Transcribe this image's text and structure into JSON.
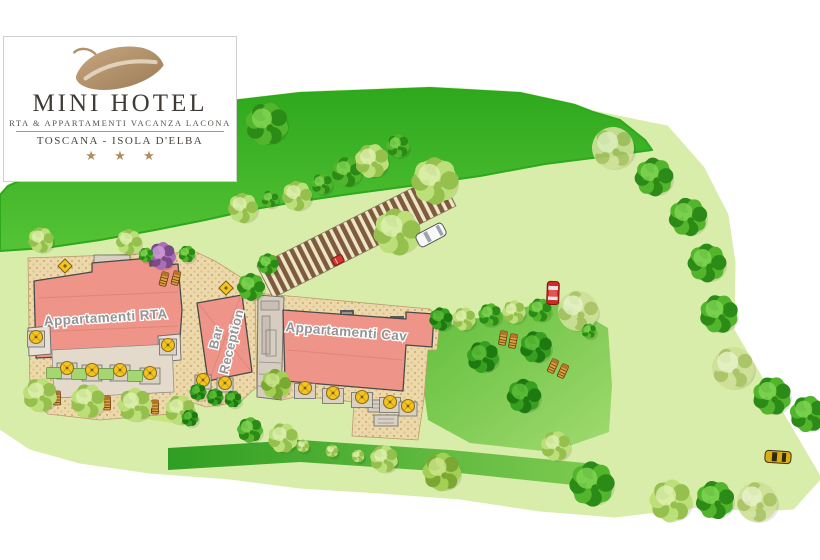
{
  "logo": {
    "hotel_name": "MINI HOTEL",
    "subtitle": "RTA & APPARTAMENTI VACANZA LACONA",
    "location": "TOSCANA - ISOLA D'ELBA",
    "stars": "★ ★ ★",
    "leaf_color": "#b3916f"
  },
  "map": {
    "labels": {
      "building_rta": "Appartamenti RTA",
      "building_bar_line1": "Bar",
      "building_bar_line2": "Reception",
      "building_cav": "Appartamenti Cav"
    },
    "palette": {
      "grounds": "#d8edaa",
      "upper_lawn_top": "#2ea81d",
      "upper_lawn_bottom": "#55c336",
      "sun_lawn_a": "#5fbe3a",
      "sun_lawn_b": "#a2da70",
      "hedge_a": "#2f9e22",
      "hedge_b": "#7cc94f",
      "shrub_band": "#c8e57f",
      "courtyard": "#ecd9ab",
      "courtyard_dots": "#d3ae74",
      "parking_stripe": "#7d5c3d",
      "parking_bg": "#f0e5c9",
      "building": "#ee9489",
      "building_outline": "#4a4a4a",
      "terrace": "#dad1c5",
      "planter": "#a6d672",
      "parasol": "#f3c41f",
      "lounger": "#e2a03a",
      "tree_green": [
        "#52b52c",
        "#2c8a16",
        "#86d957"
      ],
      "tree_dark": [
        "#38a021",
        "#1e7a10",
        "#63c23c"
      ],
      "tree_lime": [
        "#a4cf55",
        "#7aa832",
        "#d0e893"
      ],
      "tree_pale": [
        "#bcdf7a",
        "#95c04e",
        "#e2f2b4"
      ],
      "tree_sparse": [
        "#cfe098",
        "#a8c263",
        "#eef6d2"
      ],
      "tree_purple": [
        "#a96fb4",
        "#7c4a8a",
        "#d2a3da"
      ]
    },
    "trees": [
      [
        41,
        240,
        12,
        "pale"
      ],
      [
        129,
        242,
        12,
        "pale"
      ],
      [
        267,
        124,
        20,
        "green"
      ],
      [
        243,
        208,
        14,
        "pale"
      ],
      [
        270,
        199,
        8,
        "green"
      ],
      [
        297,
        196,
        14,
        "pale"
      ],
      [
        322,
        184,
        10,
        "green"
      ],
      [
        347,
        172,
        14,
        "green"
      ],
      [
        372,
        161,
        16,
        "pale"
      ],
      [
        398,
        146,
        11,
        "green"
      ],
      [
        162,
        256,
        13,
        "purple"
      ],
      [
        187,
        254,
        8,
        "green"
      ],
      [
        146,
        255,
        7,
        "green"
      ],
      [
        435,
        181,
        22,
        "pale"
      ],
      [
        397,
        232,
        22,
        "pale"
      ],
      [
        268,
        264,
        10,
        "green"
      ],
      [
        251,
        287,
        13,
        "green"
      ],
      [
        613,
        148,
        21,
        "sparse"
      ],
      [
        654,
        177,
        18,
        "green"
      ],
      [
        688,
        217,
        18,
        "green"
      ],
      [
        707,
        263,
        18,
        "green"
      ],
      [
        719,
        314,
        18,
        "green"
      ],
      [
        733,
        368,
        21,
        "sparse"
      ],
      [
        772,
        396,
        18,
        "green"
      ],
      [
        808,
        414,
        17,
        "green"
      ],
      [
        441,
        319,
        11,
        "dark"
      ],
      [
        464,
        319,
        11,
        "pale"
      ],
      [
        490,
        315,
        11,
        "green"
      ],
      [
        514,
        312,
        11,
        "pale"
      ],
      [
        540,
        310,
        11,
        "green"
      ],
      [
        578,
        311,
        20,
        "sparse"
      ],
      [
        589,
        331,
        7,
        "green"
      ],
      [
        483,
        357,
        15,
        "dark"
      ],
      [
        536,
        347,
        15,
        "dark"
      ],
      [
        524,
        396,
        16,
        "dark"
      ],
      [
        250,
        430,
        12,
        "green"
      ],
      [
        283,
        438,
        14,
        "pale"
      ],
      [
        303,
        446,
        6,
        "pale"
      ],
      [
        332,
        451,
        6,
        "pale"
      ],
      [
        358,
        456,
        6,
        "pale"
      ],
      [
        384,
        459,
        13,
        "pale"
      ],
      [
        442,
        472,
        18,
        "lime"
      ],
      [
        556,
        446,
        14,
        "pale"
      ],
      [
        592,
        484,
        21,
        "green"
      ],
      [
        671,
        501,
        20,
        "pale"
      ],
      [
        715,
        500,
        18,
        "green"
      ],
      [
        757,
        502,
        20,
        "sparse"
      ],
      [
        40,
        395,
        16,
        "pale"
      ],
      [
        88,
        401,
        16,
        "pale"
      ],
      [
        135,
        405,
        16,
        "pale"
      ],
      [
        180,
        410,
        14,
        "pale"
      ],
      [
        190,
        418,
        8,
        "dark"
      ],
      [
        198,
        392,
        8,
        "dark"
      ],
      [
        215,
        397,
        8,
        "dark"
      ],
      [
        233,
        399,
        8,
        "dark"
      ],
      [
        276,
        384,
        14,
        "lime"
      ]
    ],
    "umbrellas": [
      [
        36,
        337
      ],
      [
        168,
        345
      ],
      [
        67,
        368
      ],
      [
        92,
        370
      ],
      [
        120,
        370
      ],
      [
        150,
        373
      ],
      [
        203,
        380
      ],
      [
        225,
        383
      ],
      [
        305,
        388
      ],
      [
        333,
        393
      ],
      [
        362,
        397
      ],
      [
        390,
        402
      ],
      [
        408,
        406
      ]
    ],
    "terraces": [
      [
        36,
        339,
        17,
        16
      ],
      [
        168,
        347,
        17,
        16
      ],
      [
        67,
        371,
        20,
        16
      ],
      [
        92,
        373,
        20,
        16
      ],
      [
        120,
        373,
        20,
        16
      ],
      [
        150,
        376,
        20,
        16
      ],
      [
        203,
        382,
        16,
        14
      ],
      [
        225,
        385,
        16,
        14
      ],
      [
        305,
        391,
        21,
        15
      ],
      [
        333,
        396,
        21,
        15
      ],
      [
        362,
        400,
        21,
        15
      ],
      [
        390,
        405,
        21,
        15
      ],
      [
        408,
        409,
        18,
        14
      ]
    ],
    "planters": [
      [
        54,
        373
      ],
      [
        79,
        374
      ],
      [
        106,
        374
      ],
      [
        135,
        376
      ]
    ],
    "tables": [
      [
        65,
        266
      ],
      [
        226,
        288
      ]
    ],
    "loungers": [
      [
        57,
        398,
        0
      ],
      [
        79,
        401,
        0
      ],
      [
        107,
        403,
        0
      ],
      [
        127,
        405,
        0
      ],
      [
        155,
        407,
        0
      ],
      [
        176,
        409,
        0
      ],
      [
        164,
        279,
        15
      ],
      [
        176,
        278,
        15
      ],
      [
        503,
        338,
        10
      ],
      [
        513,
        341,
        10
      ],
      [
        553,
        366,
        25
      ],
      [
        563,
        371,
        25
      ]
    ],
    "cars": [
      {
        "name": "white-car",
        "color": "#f8f8f8",
        "x": 431,
        "y": 235,
        "angle": -28
      },
      {
        "name": "red-car",
        "color": "#cf2b24",
        "x": 553,
        "y": 293,
        "angle": 2
      },
      {
        "name": "red-mini",
        "color": "#d23430",
        "x": 338,
        "y": 260,
        "angle": -28
      },
      {
        "name": "yellow-car",
        "color": "#d8ad17",
        "x": 778,
        "y": 457,
        "angle": 4
      }
    ]
  }
}
